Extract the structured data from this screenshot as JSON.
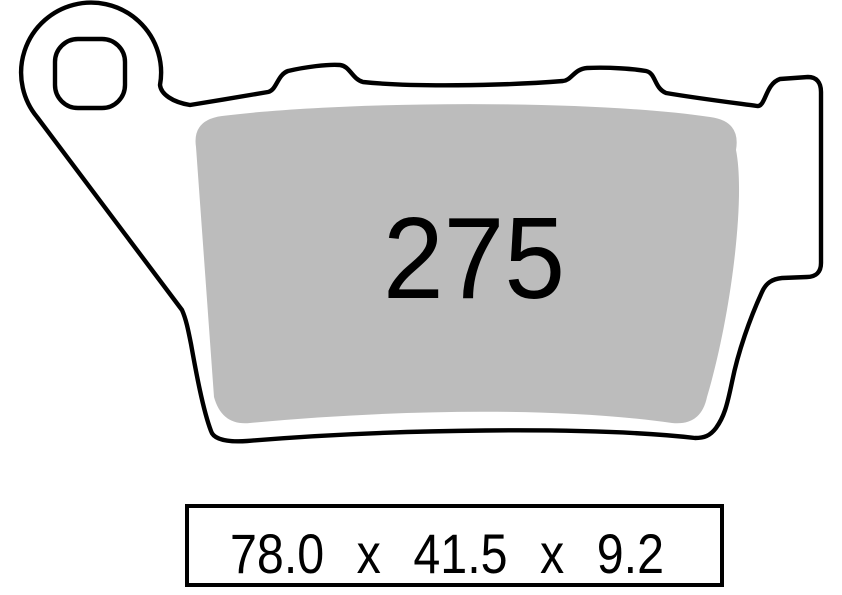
{
  "pad": {
    "number": "275",
    "dimensions_label": "78.0 x 41.5 x 9.2",
    "dimensions": {
      "width_mm": 78.0,
      "height_mm": 41.5,
      "thickness_mm": 9.2
    }
  },
  "colors": {
    "background": "#ffffff",
    "outline": "#000000",
    "friction_material": "#bcbcbc",
    "text": "#000000"
  }
}
